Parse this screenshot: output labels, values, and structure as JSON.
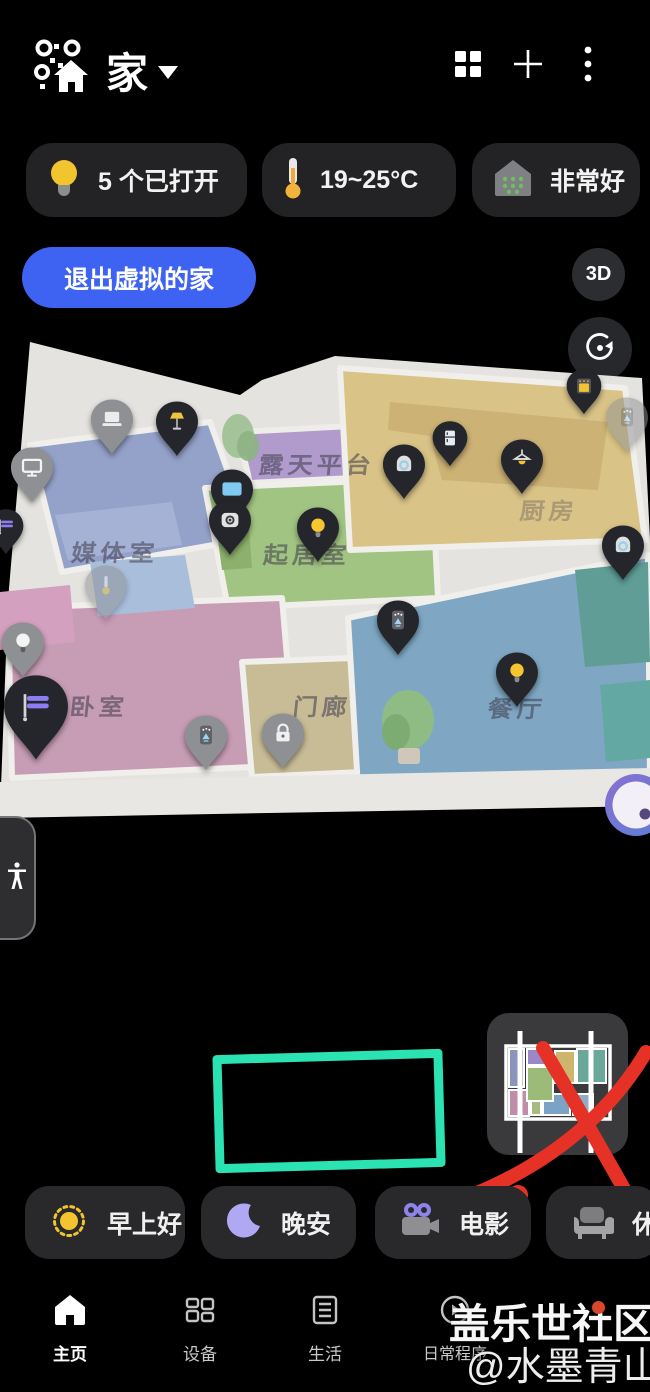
{
  "colors": {
    "accent_blue": "#3E63F2",
    "annotation_teal": "#2BE3B2",
    "annotation_red": "#E53126",
    "pin_dark": "#24262b",
    "pin_gray": "#8f9094"
  },
  "header": {
    "title": "家",
    "logo_icon": "smartthings-home-logo",
    "dropdown_icon": "caret-down-icon",
    "actions": [
      {
        "icon": "grid-icon"
      },
      {
        "icon": "plus-icon"
      },
      {
        "icon": "more-options-icon"
      }
    ]
  },
  "status_chips": [
    {
      "icon": "lightbulb-icon",
      "label": "5 个已打开"
    },
    {
      "icon": "thermometer-icon",
      "label": "19~25°C"
    },
    {
      "icon": "air-quality-house-icon",
      "label": "非常好"
    }
  ],
  "map_view": {
    "exit_button_label": "退出虚拟的家",
    "view_mode_label": "3D",
    "rotate_button_icon": "rotate-view-icon",
    "joystick_icon": "pan-joystick",
    "accessibility_icon": "accessibility-person-icon",
    "rooms": [
      {
        "label": "媒体室",
        "x": 115,
        "y": 212,
        "dim": false
      },
      {
        "label": "露天平台",
        "x": 317,
        "y": 124,
        "dim": false
      },
      {
        "label": "起居室",
        "x": 307,
        "y": 214,
        "dim": false
      },
      {
        "label": "厨房",
        "x": 549,
        "y": 170,
        "dim": true
      },
      {
        "label": "卧室",
        "x": 99,
        "y": 366,
        "dim": false
      },
      {
        "label": "门廊",
        "x": 322,
        "y": 366,
        "dim": false
      },
      {
        "label": "餐厅",
        "x": 517,
        "y": 368,
        "dim": false
      }
    ],
    "pins": [
      {
        "icon": "laptop",
        "variant": "gray",
        "x": 112,
        "y": 82
      },
      {
        "icon": "floor-lamp",
        "variant": "dark",
        "x": 177,
        "y": 84
      },
      {
        "icon": "tv",
        "variant": "gray",
        "x": 32,
        "y": 130
      },
      {
        "icon": "blinds",
        "variant": "dark",
        "x": 6,
        "y": 188,
        "size": "small"
      },
      {
        "icon": "tv-screen",
        "variant": "dark",
        "x": 232,
        "y": 152
      },
      {
        "icon": "camera",
        "variant": "dark",
        "x": 230,
        "y": 183
      },
      {
        "icon": "bulb-on",
        "variant": "dark",
        "x": 318,
        "y": 190
      },
      {
        "icon": "cam-dome",
        "variant": "dark",
        "x": 404,
        "y": 127
      },
      {
        "icon": "fridge",
        "variant": "dark",
        "x": 450,
        "y": 100,
        "size": "small"
      },
      {
        "icon": "oven",
        "variant": "dark",
        "x": 584,
        "y": 48,
        "size": "small"
      },
      {
        "icon": "purifier",
        "variant": "faded",
        "x": 627,
        "y": 80
      },
      {
        "icon": "pendant-light",
        "variant": "dark",
        "x": 522,
        "y": 122
      },
      {
        "icon": "cam-dome",
        "variant": "dark",
        "x": 623,
        "y": 208
      },
      {
        "icon": "thermometer",
        "variant": "faded",
        "x": 106,
        "y": 248
      },
      {
        "icon": "bulb-off",
        "variant": "gray",
        "x": 23,
        "y": 305
      },
      {
        "icon": "blinds",
        "variant": "dark",
        "x": 36,
        "y": 370,
        "size": "large"
      },
      {
        "icon": "purifier",
        "variant": "gray",
        "x": 206,
        "y": 398
      },
      {
        "icon": "lock",
        "variant": "gray",
        "x": 283,
        "y": 396
      },
      {
        "icon": "purifier",
        "variant": "dark",
        "x": 398,
        "y": 283
      },
      {
        "icon": "bulb-on",
        "variant": "dark",
        "x": 517,
        "y": 335
      }
    ]
  },
  "annotations": {
    "highlight_box": "teal-rectangle-annotation",
    "crossed_out_minimap": "red-x-annotation"
  },
  "scenes": [
    {
      "icon": "sun-icon",
      "label": "早上好"
    },
    {
      "icon": "moon-icon",
      "label": "晚安"
    },
    {
      "icon": "movie-camera-icon",
      "label": "电影"
    },
    {
      "icon": "sofa-icon",
      "label": "休息"
    }
  ],
  "nav": [
    {
      "icon": "home-icon",
      "label": "主页",
      "active": true
    },
    {
      "icon": "devices-icon",
      "label": "设备",
      "active": false
    },
    {
      "icon": "life-icon",
      "label": "生活",
      "active": false
    },
    {
      "icon": "routines-icon",
      "label": "日常程序",
      "active": false
    }
  ],
  "watermark": {
    "line1": "盖乐世社区",
    "line2": "@水墨青山"
  }
}
